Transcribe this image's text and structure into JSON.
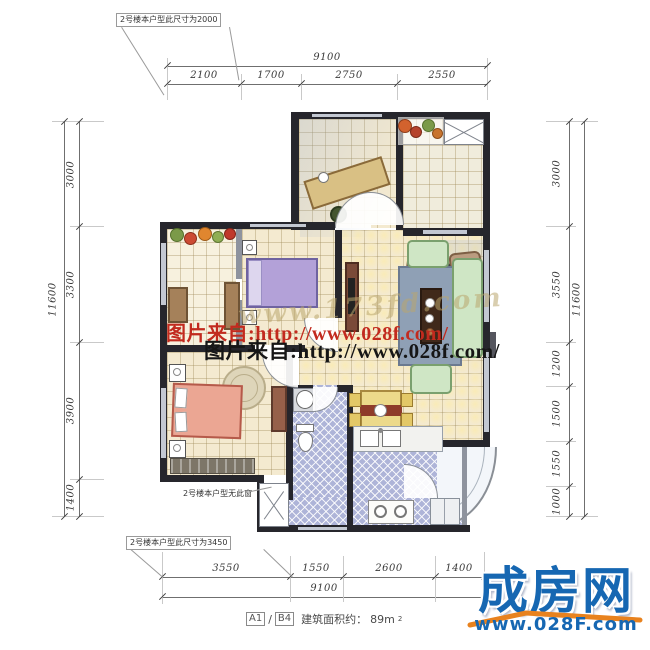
{
  "annotations": {
    "top_note": "2号楼本户型此尺寸为2000",
    "no_window_note": "2号楼本户型无此窗",
    "bottom_note": "2号楼本户型此尺寸为3450"
  },
  "dimensions": {
    "top": {
      "total": "9100",
      "segments": [
        "2100",
        "1700",
        "2750",
        "2550"
      ]
    },
    "bottom": {
      "total": "9100",
      "segments": [
        "3550",
        "1550",
        "2600",
        "1400"
      ]
    },
    "left": {
      "total": "11600",
      "segments": [
        "3000",
        "3300",
        "3900",
        "1400"
      ]
    },
    "right": {
      "total": "11600",
      "segments": [
        "3000",
        "3550",
        "1200",
        "1500",
        "1550",
        "1000"
      ]
    }
  },
  "watermarks": {
    "faint": "www.173fd.com",
    "red": "图片来自:http://www.028f.com/",
    "black": "图片来自:http://www.028f.com/",
    "red_color": "#c22a1e"
  },
  "caption": {
    "unit_a": "A1",
    "separator": "/",
    "unit_b": "B4",
    "label": "建筑面积约：",
    "value": "89m",
    "sup": "2"
  },
  "logo": {
    "brand": "成房网",
    "url": "www.028F.com",
    "brand_color": "#1667b2",
    "swoosh_color": "#e8821e"
  }
}
